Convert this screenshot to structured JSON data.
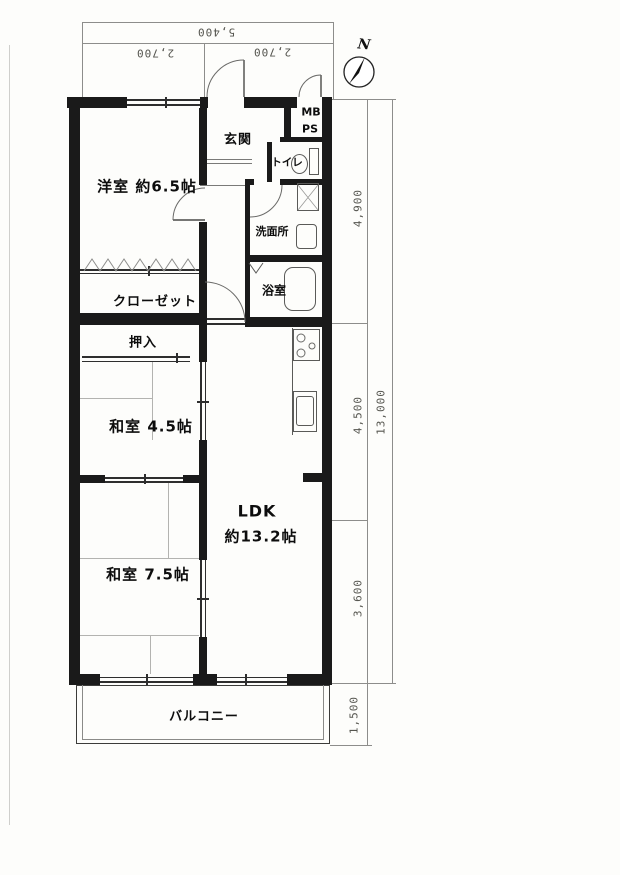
{
  "compass": {
    "north_label": "N"
  },
  "dims": {
    "top_total": "5,400",
    "top_left": "2,700",
    "top_right": "2,700",
    "right_upper": "4,900",
    "right_middle": "4,500",
    "right_lower": "3,600",
    "right_total": "13,000",
    "balcony_depth": "1,500"
  },
  "rooms": {
    "genkan": "玄関",
    "mb": "MB",
    "ps": "PS",
    "toilet": "トイレ",
    "washroom": "洗面所",
    "bath": "浴室",
    "western_room": "洋室 約6.5帖",
    "closet": "クローゼット",
    "oshiire": "押入",
    "japanese_room_45": "和室 4.5帖",
    "ldk": "LDK",
    "ldk_size": "約13.2帖",
    "japanese_room_75": "和室 7.5帖",
    "balcony": "バルコニー"
  }
}
